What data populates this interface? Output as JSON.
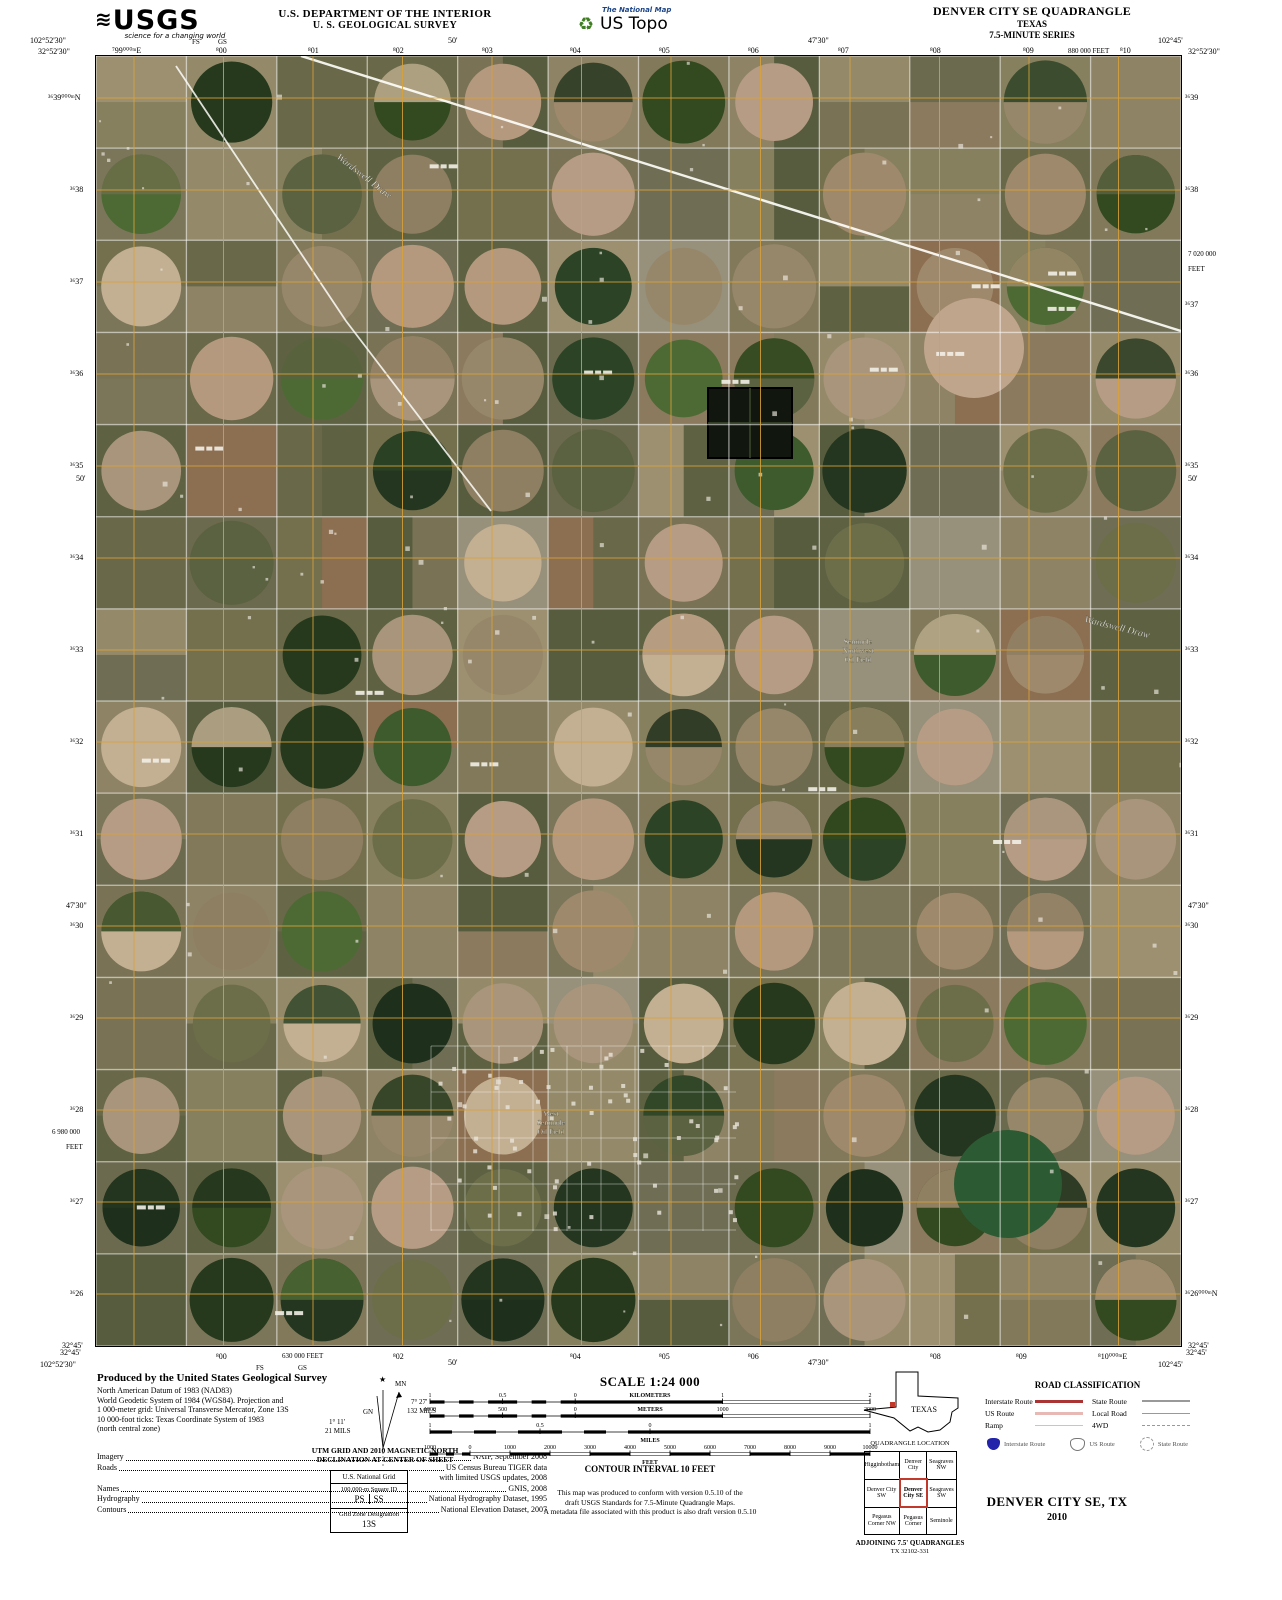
{
  "header": {
    "usgs_wave": "≋",
    "usgs_logo": "USGS",
    "usgs_tagline": "science for a changing world",
    "dept_line1": "U.S. DEPARTMENT OF THE INTERIOR",
    "dept_line2": "U. S. GEOLOGICAL SURVEY",
    "tnm_label": "The National Map",
    "ustopo_label": "US Topo",
    "recycle_icon": "♻",
    "quad_title": "DENVER CITY SE QUADRANGLE",
    "quad_state": "TEXAS",
    "quad_series": "7.5-MINUTE SERIES"
  },
  "collar": {
    "top": [
      {
        "t": "102°52'30\"",
        "x": 30,
        "y": 36
      },
      {
        "t": "32°52'30\"",
        "x": 38,
        "y": 47
      },
      {
        "t": "FS",
        "x": 192,
        "y": 38,
        "cls": "sm"
      },
      {
        "t": "GS",
        "x": 218,
        "y": 38,
        "cls": "sm"
      },
      {
        "t": "⁷99⁰⁰⁰ᵐE",
        "x": 112,
        "y": 46
      },
      {
        "t": "⁸00",
        "x": 216,
        "y": 46
      },
      {
        "t": "⁸01",
        "x": 308,
        "y": 46
      },
      {
        "t": "⁸02",
        "x": 393,
        "y": 46
      },
      {
        "t": "50'",
        "x": 448,
        "y": 36
      },
      {
        "t": "⁸03",
        "x": 482,
        "y": 46
      },
      {
        "t": "⁸04",
        "x": 570,
        "y": 46
      },
      {
        "t": "⁸05",
        "x": 659,
        "y": 46
      },
      {
        "t": "⁸06",
        "x": 748,
        "y": 46
      },
      {
        "t": "47'30\"",
        "x": 808,
        "y": 36
      },
      {
        "t": "⁸07",
        "x": 838,
        "y": 46
      },
      {
        "t": "⁸08",
        "x": 930,
        "y": 46
      },
      {
        "t": "⁸09",
        "x": 1023,
        "y": 46
      },
      {
        "t": "880 000 FEET",
        "x": 1068,
        "y": 47,
        "cls": "sm"
      },
      {
        "t": "⁸10",
        "x": 1120,
        "y": 46
      },
      {
        "t": "102°45'",
        "x": 1158,
        "y": 36
      },
      {
        "t": "32°52'30\"",
        "x": 1188,
        "y": 47
      }
    ],
    "bottom": [
      {
        "t": "32°45'",
        "x": 60,
        "y": 1348
      },
      {
        "t": "102°52'30\"",
        "x": 40,
        "y": 1360
      },
      {
        "t": "FS",
        "x": 256,
        "y": 1364,
        "cls": "sm"
      },
      {
        "t": "GS",
        "x": 298,
        "y": 1364,
        "cls": "sm"
      },
      {
        "t": "⁸00",
        "x": 216,
        "y": 1352
      },
      {
        "t": "630 000 FEET",
        "x": 282,
        "y": 1352,
        "cls": "sm"
      },
      {
        "t": "⁸02",
        "x": 393,
        "y": 1352
      },
      {
        "t": "50'",
        "x": 448,
        "y": 1358
      },
      {
        "t": "⁸04",
        "x": 570,
        "y": 1352
      },
      {
        "t": "⁸05",
        "x": 659,
        "y": 1352
      },
      {
        "t": "⁸06",
        "x": 748,
        "y": 1352
      },
      {
        "t": "47'30\"",
        "x": 808,
        "y": 1358
      },
      {
        "t": "⁸08",
        "x": 930,
        "y": 1352
      },
      {
        "t": "⁸09",
        "x": 1016,
        "y": 1352
      },
      {
        "t": "⁸10⁰⁰⁰ᵐE",
        "x": 1098,
        "y": 1352
      },
      {
        "t": "32°45'",
        "x": 1186,
        "y": 1348
      },
      {
        "t": "102°45'",
        "x": 1158,
        "y": 1360
      }
    ],
    "left": [
      {
        "t": "³⁶39⁰⁰⁰ᵐN",
        "x": 48,
        "y": 93
      },
      {
        "t": "³⁶38",
        "x": 70,
        "y": 185
      },
      {
        "t": "³⁶37",
        "x": 70,
        "y": 277
      },
      {
        "t": "³⁶36",
        "x": 70,
        "y": 369
      },
      {
        "t": "³⁶35",
        "x": 70,
        "y": 461
      },
      {
        "t": "50'",
        "x": 76,
        "y": 474
      },
      {
        "t": "³⁶34",
        "x": 70,
        "y": 553
      },
      {
        "t": "³⁶33",
        "x": 70,
        "y": 645
      },
      {
        "t": "³⁶32",
        "x": 70,
        "y": 737
      },
      {
        "t": "³⁶31",
        "x": 70,
        "y": 829
      },
      {
        "t": "47'30\"",
        "x": 66,
        "y": 901
      },
      {
        "t": "³⁶30",
        "x": 70,
        "y": 921
      },
      {
        "t": "³⁶29",
        "x": 70,
        "y": 1013
      },
      {
        "t": "³⁶28",
        "x": 70,
        "y": 1105
      },
      {
        "t": "6 980 000",
        "x": 52,
        "y": 1128,
        "cls": "sm"
      },
      {
        "t": "FEET",
        "x": 66,
        "y": 1143,
        "cls": "sm"
      },
      {
        "t": "³⁶27",
        "x": 70,
        "y": 1197
      },
      {
        "t": "³⁶26",
        "x": 70,
        "y": 1289
      },
      {
        "t": "32°45'",
        "x": 62,
        "y": 1341
      }
    ],
    "right": [
      {
        "t": "³⁶39",
        "x": 1185,
        "y": 93
      },
      {
        "t": "³⁶38",
        "x": 1185,
        "y": 185
      },
      {
        "t": "7 020 000",
        "x": 1188,
        "y": 250,
        "cls": "sm"
      },
      {
        "t": "FEET",
        "x": 1188,
        "y": 265,
        "cls": "sm"
      },
      {
        "t": "³⁶37",
        "x": 1185,
        "y": 300
      },
      {
        "t": "³⁶36",
        "x": 1185,
        "y": 369
      },
      {
        "t": "50'",
        "x": 1188,
        "y": 474
      },
      {
        "t": "³⁶35",
        "x": 1185,
        "y": 461
      },
      {
        "t": "³⁶34",
        "x": 1185,
        "y": 553
      },
      {
        "t": "³⁶33",
        "x": 1185,
        "y": 645
      },
      {
        "t": "³⁶32",
        "x": 1185,
        "y": 737
      },
      {
        "t": "³⁶31",
        "x": 1185,
        "y": 829
      },
      {
        "t": "47'30\"",
        "x": 1188,
        "y": 901
      },
      {
        "t": "³⁶30",
        "x": 1185,
        "y": 921
      },
      {
        "t": "³⁶29",
        "x": 1185,
        "y": 1013
      },
      {
        "t": "³⁶28",
        "x": 1185,
        "y": 1105
      },
      {
        "t": "³⁶27",
        "x": 1185,
        "y": 1197
      },
      {
        "t": "³⁶26⁰⁰⁰ᵐN",
        "x": 1185,
        "y": 1289
      },
      {
        "t": "32°45'",
        "x": 1188,
        "y": 1341
      }
    ]
  },
  "map": {
    "labels": [
      {
        "text": "Wardswell Draw",
        "x": 240,
        "y": 102,
        "rotate": 38
      },
      {
        "text": "Wardswell Draw",
        "x": 988,
        "y": 566,
        "rotate": 14
      }
    ],
    "area_labels": [
      {
        "lines": [
          "Seminole",
          "Northwest",
          "Oil Field"
        ],
        "x": 762,
        "y": 588
      },
      {
        "lines": [
          "West",
          "Seminole",
          "Oil Field"
        ],
        "x": 455,
        "y": 1060
      }
    ]
  },
  "map_render": {
    "seed": 1337,
    "base": "#6f6b52",
    "grid_color": "#d9a23a",
    "road_color": "#ffffff",
    "field_palette": [
      "#7b7659",
      "#6c6a4e",
      "#86805f",
      "#8e8365",
      "#74704e",
      "#5e6242",
      "#948a6a",
      "#797255",
      "#696848",
      "#81795a",
      "#575c3e",
      "#8b7a5e",
      "#9c9071",
      "#6f6e55",
      "#8c6e50",
      "#97907b"
    ],
    "circle_palette": [
      "#24361f",
      "#2c4325",
      "#1e301b",
      "#3e5b2e",
      "#4d6a34",
      "#8e7e62",
      "#9f896c",
      "#b4997e",
      "#a8957c",
      "#c3af92",
      "#5b6241",
      "#6c6e4a",
      "#b69c84",
      "#97876a",
      "#33491f",
      "#26391d"
    ]
  },
  "footer": {
    "produced_title": "Produced by the United States Geological Survey",
    "datum_lines": [
      "North American Datum of 1983 (NAD83)",
      "World Geodetic System of 1984 (WGS84).  Projection and",
      "1 000-meter grid: Universal Transverse Mercator, Zone 13S",
      "10 000-foot ticks: Texas Coordinate System of 1983",
      "(north central zone)"
    ],
    "credits": [
      {
        "label": "Imagery",
        "value": "NAIP, September 2008"
      },
      {
        "label": "Roads",
        "value": "US Census Bureau TIGER data"
      },
      {
        "label": "",
        "value": "with limited USGS updates, 2008"
      },
      {
        "label": "Names",
        "value": "GNIS, 2008"
      },
      {
        "label": "Hydrography",
        "value": "National Hydrography Dataset, 1995"
      },
      {
        "label": "Contours",
        "value": "National Elevation Dataset, 2007"
      }
    ],
    "declination": {
      "star": "★",
      "mn_label": "MN",
      "gn_label": "GN",
      "right_deg": "7° 27'",
      "right_mils": "132 MILS",
      "left_deg": "1° 11'",
      "left_mils": "21 MILS",
      "caption1": "UTM GRID AND 2010 MAGNETIC NORTH",
      "caption2": "DECLINATION AT CENTER OF SHEET"
    },
    "usng": {
      "title": "U.S. National Grid",
      "sub": "100,000-m Square ID",
      "left": "PS",
      "right": "SS",
      "zone_label": "Grid Zone Designation",
      "zone": "13S"
    },
    "scale": {
      "title": "SCALE 1:24 000",
      "km_ticks": [
        "1",
        "0.5",
        "0",
        "1",
        "2"
      ],
      "km_label": "KILOMETERS",
      "m_ticks": [
        "1000",
        "500",
        "0",
        "1000",
        "2000"
      ],
      "m_label": "METERS",
      "mi_ticks": [
        "1",
        "0.5",
        "0",
        "1"
      ],
      "mi_label": "MILES",
      "ft_ticks": [
        "1000",
        "0",
        "1000",
        "2000",
        "3000",
        "4000",
        "5000",
        "6000",
        "7000",
        "8000",
        "9000",
        "10000"
      ],
      "ft_label": "FEET"
    },
    "contour": "CONTOUR INTERVAL 10 FEET",
    "note_lines": [
      "This map was produced to conform with version 0.5.10 of the",
      "draft USGS Standards for 7.5-Minute Quadrangle Maps.",
      "A metadata file associated with this product is also draft version 0.5.10"
    ],
    "quad_location": {
      "state_label": "TEXAS",
      "caption": "QUADRANGLE LOCATION",
      "grid": [
        "Higginbotham",
        "Denver City",
        "Seagraves NW",
        "Denver City SW",
        "Denver City SE",
        "Seagraves SW",
        "Pegasus Corner NW",
        "Pegasus Corner",
        "Seminole"
      ],
      "adjoining1": "ADJOINING 7.5' QUADRANGLES",
      "adjoining2": "TX 32102-331"
    },
    "road_class": {
      "title": "ROAD CLASSIFICATION",
      "rows_left": [
        {
          "label": "Interstate Route",
          "style": "interstate"
        },
        {
          "label": "US Route",
          "style": "us"
        },
        {
          "label": "Ramp",
          "style": "ramp"
        }
      ],
      "rows_right": [
        {
          "label": "State Route",
          "style": "state"
        },
        {
          "label": "Local Road",
          "style": "local"
        },
        {
          "label": "4WD",
          "style": "fourwd"
        }
      ],
      "shields": [
        {
          "label": "Interstate Route",
          "style": "interstate"
        },
        {
          "label": "US Route",
          "style": "us"
        },
        {
          "label": "State Route",
          "style": "state"
        }
      ]
    },
    "sheet_title": "DENVER CITY SE, TX",
    "sheet_year": "2010"
  }
}
